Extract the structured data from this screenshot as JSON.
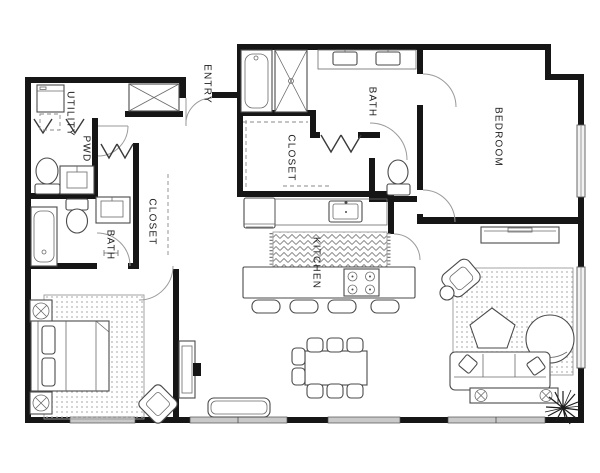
{
  "labels": {
    "utility": "UTILITY",
    "pwd": "PWD",
    "entry": "ENTRY",
    "master_bath": "BATH",
    "master_closet": "CLOSET",
    "bedroom": "BEDROOM",
    "second_bath": "BATH",
    "second_closet": "CLOSET",
    "kitchen": "KITCHEN"
  },
  "colors": {
    "wall": "#161616",
    "furniture_outline": "#4a4a4a",
    "door_swing": "#9a9a9a",
    "window_fill": "#c9c9c9",
    "background": "#ffffff"
  },
  "furniture": [
    "washer",
    "coat-closet",
    "bathtub-master",
    "shower",
    "double-vanity",
    "toilet-master",
    "linen-bifold-closet",
    "powder-toilet",
    "powder-vanity",
    "bath2-tub",
    "bath2-toilet",
    "bath2-vanity",
    "fridge",
    "kitchen-sink",
    "range-cooktop",
    "kitchen-island",
    "bar-stools",
    "runner-rug",
    "dining-table",
    "dining-chairs",
    "bench-ottoman",
    "hall-console-tv",
    "bed",
    "nightstands",
    "bedroom2-rug",
    "accent-chair",
    "living-rug",
    "armchair",
    "side-table",
    "coffee-table",
    "round-chair",
    "sofa",
    "console-table",
    "plant",
    "media-dresser"
  ]
}
